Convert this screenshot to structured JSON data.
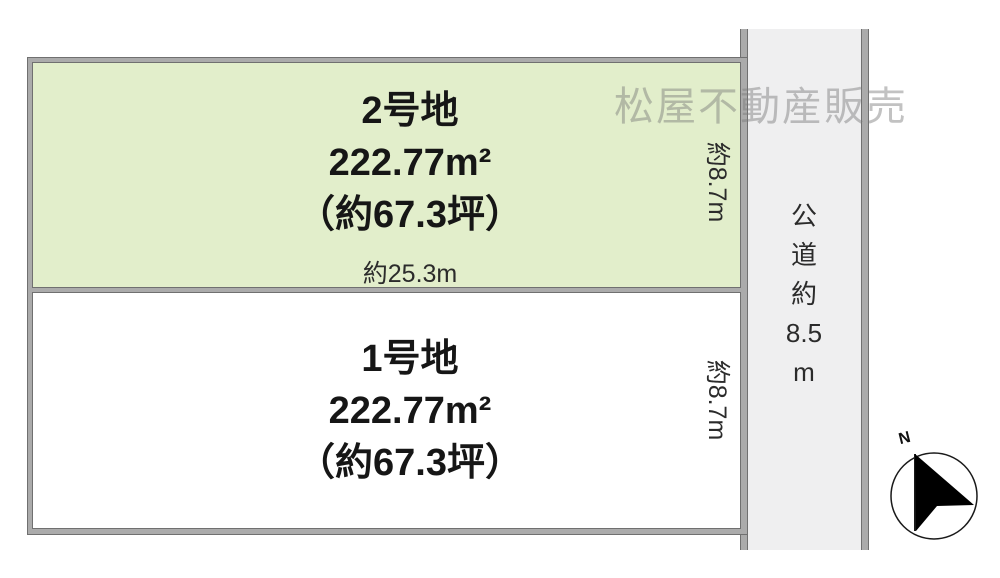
{
  "watermark": "松屋不動産販売",
  "plots": {
    "plot2": {
      "name": "2号地",
      "area": "222.77m²",
      "tsubo": "（約67.3坪）",
      "frontage": "約25.3m",
      "depth": "約8.7m",
      "fill": "#e2eecb"
    },
    "plot1": {
      "name": "1号地",
      "area": "222.77m²",
      "tsubo": "（約67.3坪）",
      "depth": "約8.7m",
      "fill": "#ffffff"
    }
  },
  "road": {
    "label": "公道約8.5m",
    "chars": [
      "公",
      "道",
      "約",
      "8.5",
      "m"
    ],
    "fill": "#efeff0"
  },
  "compass": {
    "north": "N"
  },
  "colors": {
    "border_band": "#ababab",
    "border_edge": "#707070",
    "text_primary": "#161616",
    "text_secondary": "#2b2b2b",
    "watermark": "#c2c2c2"
  }
}
